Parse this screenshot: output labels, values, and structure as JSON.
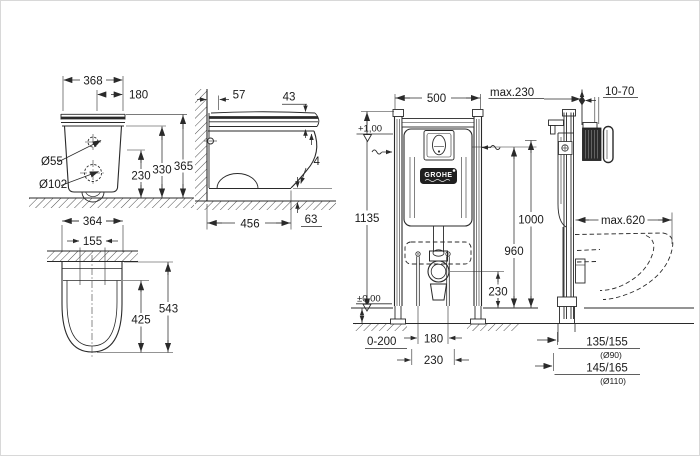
{
  "brand": {
    "logo_text": "GROHE"
  },
  "views": {
    "wc_front": {
      "dims": {
        "overall_width": "368",
        "top_fixing_width": "180",
        "supply_diameter": "Ø55",
        "outlet_diameter": "Ø102",
        "height_1": "230",
        "height_2": "330",
        "height_3": "365"
      }
    },
    "wc_side": {
      "dims": {
        "wall_to_fixing": "57",
        "seat_thickness": "43",
        "partial_value": "4",
        "depth": "456",
        "underside_clearance": "63"
      }
    },
    "wc_plan": {
      "dims": {
        "overall_width": "364",
        "fixing_width": "155",
        "inner_length": "425",
        "overall_length": "543"
      }
    },
    "frame_front": {
      "dims": {
        "frame_width": "500",
        "frame_height": "1135",
        "actuation_height": "1000",
        "supply_height": "960",
        "outlet_height": "230",
        "level_plus": "+1,00",
        "level_zero": "±0,00",
        "screed_range": "0-200",
        "rod_spacing": "180",
        "fixing_spacing": "230"
      }
    },
    "frame_side": {
      "dims": {
        "max_wall_depth": "max.230",
        "plate_adjust": "10-70",
        "max_bowl_depth": "max.620",
        "stub_upper": "135/155",
        "stub_upper_dia": "(Ø90)",
        "stub_lower": "145/165",
        "stub_lower_dia": "(Ø110)"
      }
    }
  }
}
